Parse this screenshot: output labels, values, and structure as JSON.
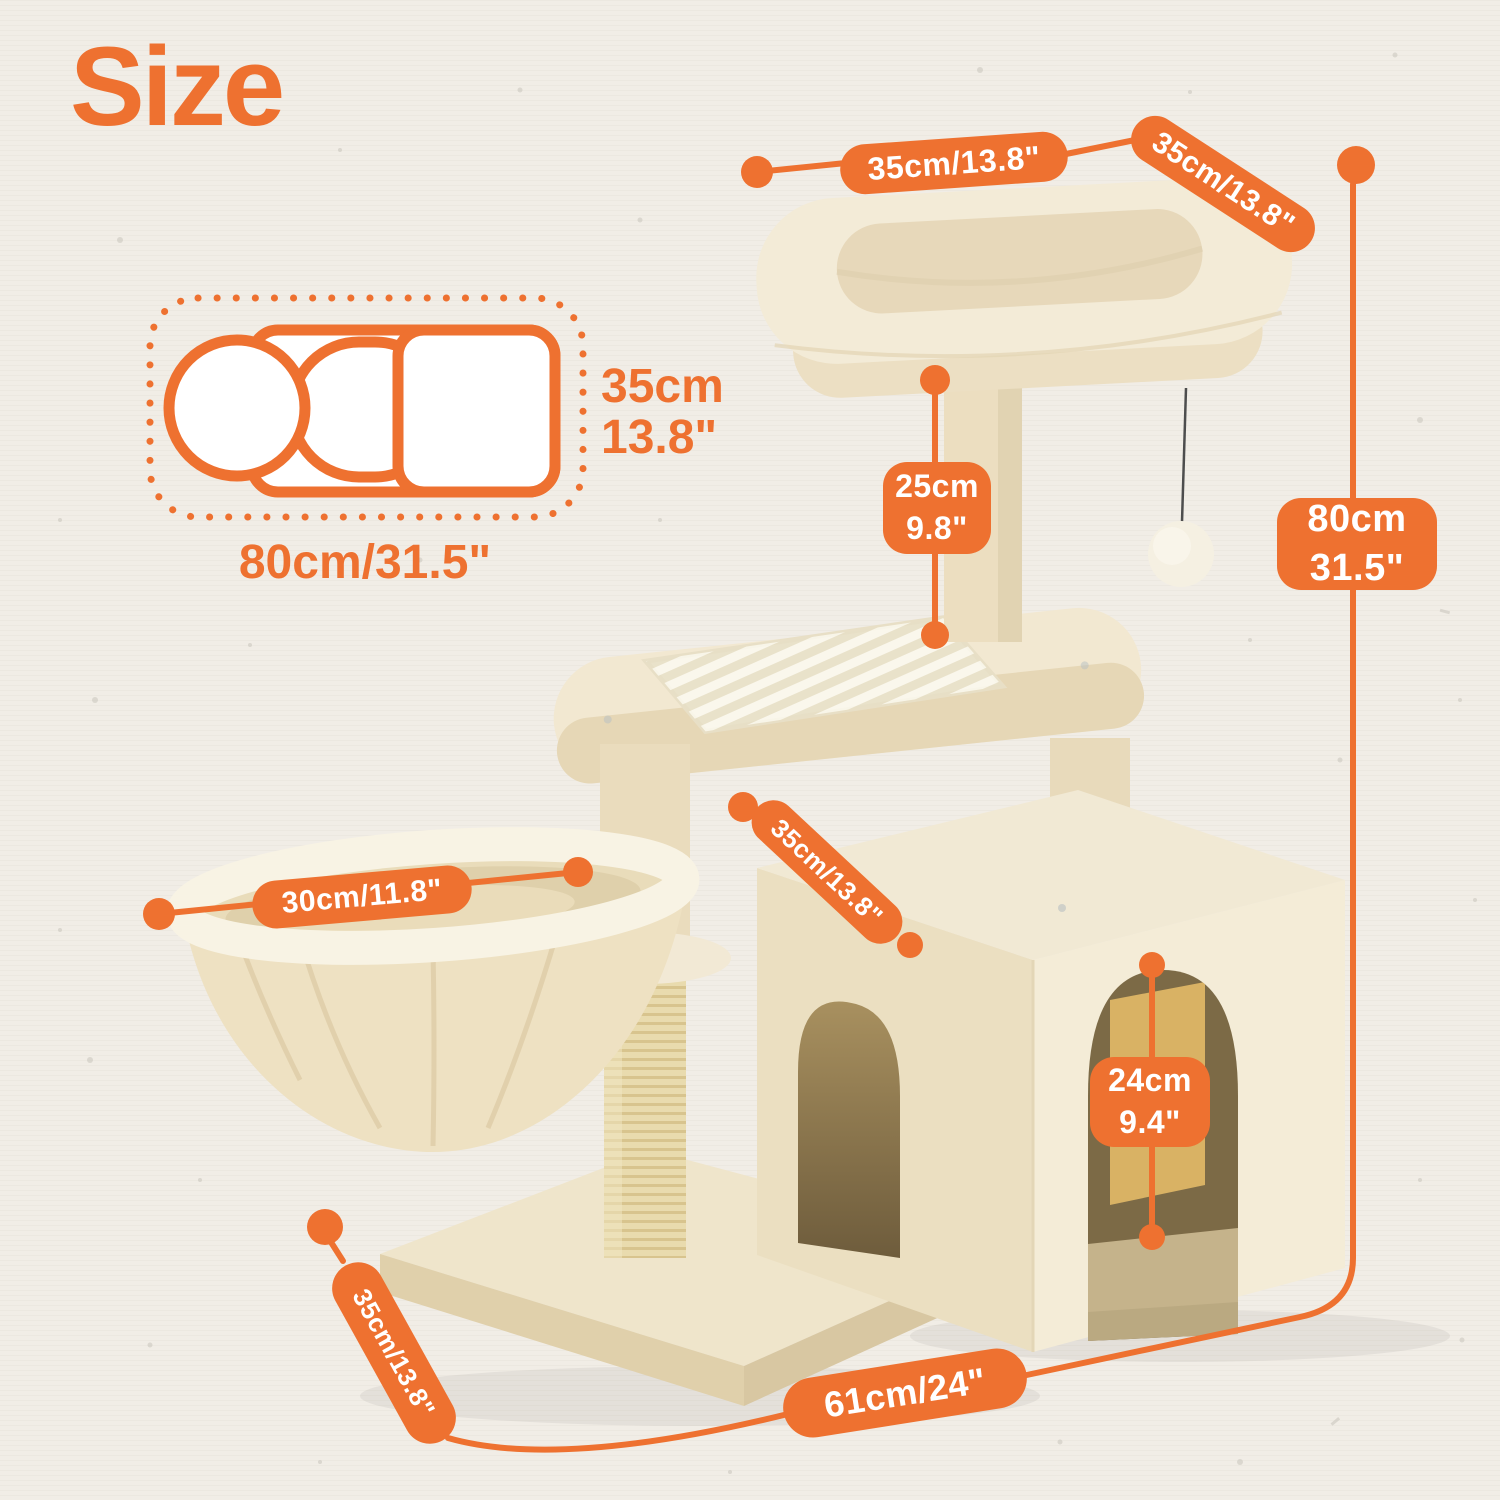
{
  "title": "Size",
  "colors": {
    "accent_orange": "#ee7130",
    "background_paper": "#f1ede6",
    "plush_beige": "#f2e8d3",
    "sisal": "#e8d9ae"
  },
  "folded_diagram": {
    "height_line1": "35cm",
    "height_line2": "13.8\"",
    "width_label": "80cm/31.5\""
  },
  "dimensions": {
    "top_perch_width": "35cm/13.8\"",
    "top_perch_depth": "35cm/13.8\"",
    "top_post_height_cm": "25cm",
    "top_post_height_in": "9.8\"",
    "total_height_cm": "80cm",
    "total_height_in": "31.5\"",
    "basket_diameter": "30cm/11.8\"",
    "condo_width": "35cm/13.8\"",
    "door_height_cm": "24cm",
    "door_height_in": "9.4\"",
    "base_depth": "35cm/13.8\"",
    "base_width": "61cm/24\""
  }
}
